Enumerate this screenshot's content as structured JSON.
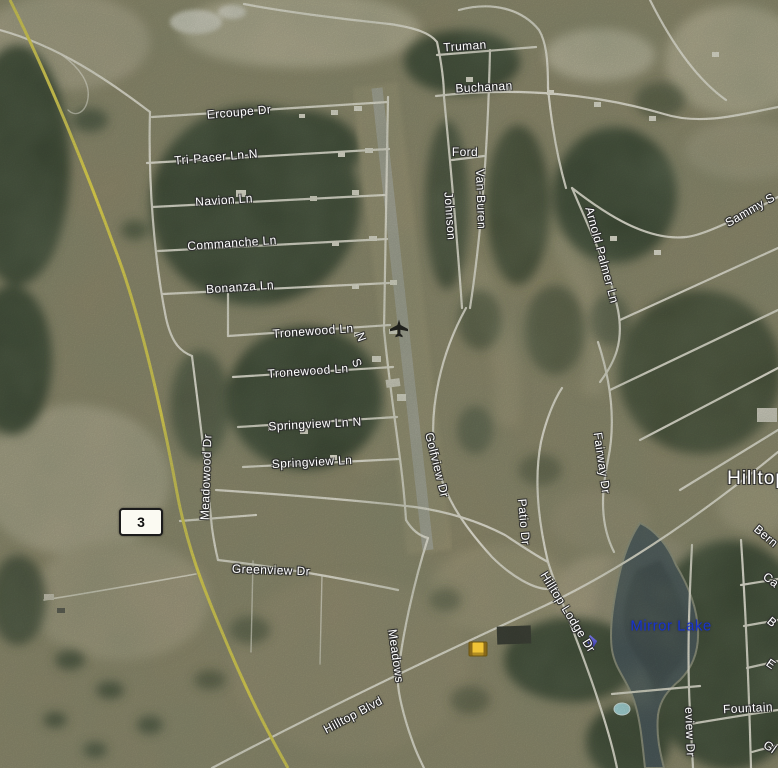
{
  "map": {
    "kind": "satellite-aerial-view",
    "street_labels": [
      {
        "text": "Truman",
        "x": 465,
        "y": 46,
        "rot": -4
      },
      {
        "text": "Buchanan",
        "x": 484,
        "y": 87,
        "rot": -3
      },
      {
        "text": "Ercoupe Dr",
        "x": 239,
        "y": 112,
        "rot": -5
      },
      {
        "text": "Tri-Pacer Ln-N",
        "x": 216,
        "y": 157,
        "rot": -5
      },
      {
        "text": "Ford",
        "x": 465,
        "y": 152,
        "rot": 0
      },
      {
        "text": "Navion Ln",
        "x": 224,
        "y": 200,
        "rot": -4
      },
      {
        "text": "Johnson",
        "x": 450,
        "y": 216,
        "rot": 86
      },
      {
        "text": "Van-Buren",
        "x": 481,
        "y": 199,
        "rot": 88
      },
      {
        "text": "Sammy S",
        "x": 750,
        "y": 210,
        "rot": -30
      },
      {
        "text": "Commanche Ln",
        "x": 232,
        "y": 243,
        "rot": -4
      },
      {
        "text": "Arnold Palmer Ln",
        "x": 602,
        "y": 255,
        "rot": 75
      },
      {
        "text": "Bonanza Ln",
        "x": 240,
        "y": 287,
        "rot": -4
      },
      {
        "text": "Tronewood Ln",
        "x": 313,
        "y": 331,
        "rot": -4
      },
      {
        "text": "N",
        "x": 361,
        "y": 337,
        "rot": 70
      },
      {
        "text": "S",
        "x": 357,
        "y": 363,
        "rot": 70
      },
      {
        "text": "Tronewood Ln",
        "x": 308,
        "y": 371,
        "rot": -4
      },
      {
        "text": "Springview Ln N",
        "x": 315,
        "y": 424,
        "rot": -3
      },
      {
        "text": "Springview Ln",
        "x": 312,
        "y": 462,
        "rot": -3
      },
      {
        "text": "Meadowood Dr",
        "x": 206,
        "y": 477,
        "rot": -88
      },
      {
        "text": "Golfview Dr",
        "x": 437,
        "y": 465,
        "rot": 76
      },
      {
        "text": "Fairway Dr",
        "x": 602,
        "y": 463,
        "rot": 82
      },
      {
        "text": "Patio Dr",
        "x": 524,
        "y": 522,
        "rot": 85
      },
      {
        "text": "Bern",
        "x": 766,
        "y": 536,
        "rot": 40
      },
      {
        "text": "Greenview Dr",
        "x": 271,
        "y": 570,
        "rot": 2
      },
      {
        "text": "Ca",
        "x": 771,
        "y": 580,
        "rot": 38
      },
      {
        "text": "Hilltop Lodge Dr",
        "x": 568,
        "y": 612,
        "rot": 58
      },
      {
        "text": "B",
        "x": 772,
        "y": 622,
        "rot": 40
      },
      {
        "text": "Meadows",
        "x": 396,
        "y": 656,
        "rot": 82
      },
      {
        "text": "E",
        "x": 771,
        "y": 664,
        "rot": 35
      },
      {
        "text": "Fountain",
        "x": 748,
        "y": 708,
        "rot": -3
      },
      {
        "text": "Hilltop Blvd",
        "x": 353,
        "y": 715,
        "rot": -28
      },
      {
        "text": "eview Dr",
        "x": 690,
        "y": 732,
        "rot": 88
      },
      {
        "text": "Gl",
        "x": 770,
        "y": 747,
        "rot": 35
      }
    ],
    "place_labels": [
      {
        "text": "Hilltop",
        "x": 757,
        "y": 479,
        "rot": 0,
        "class": "place-big"
      },
      {
        "text": "Mirror Lake",
        "x": 671,
        "y": 626,
        "rot": 0,
        "class": "water-name"
      }
    ],
    "route_shield": {
      "text": "3"
    },
    "icons": {
      "airplane": {
        "x": 399,
        "y": 331
      },
      "school": {
        "x": 478,
        "y": 649
      },
      "poi-flag": {
        "x": 592,
        "y": 642
      }
    },
    "colors": {
      "highway_yellow": "#e3d64e",
      "road_white": "#f0ede0",
      "water": "#465459",
      "water_label_blue": "#1733cf",
      "forest_green": "#3c4834",
      "field_tan": "#aea888"
    }
  }
}
